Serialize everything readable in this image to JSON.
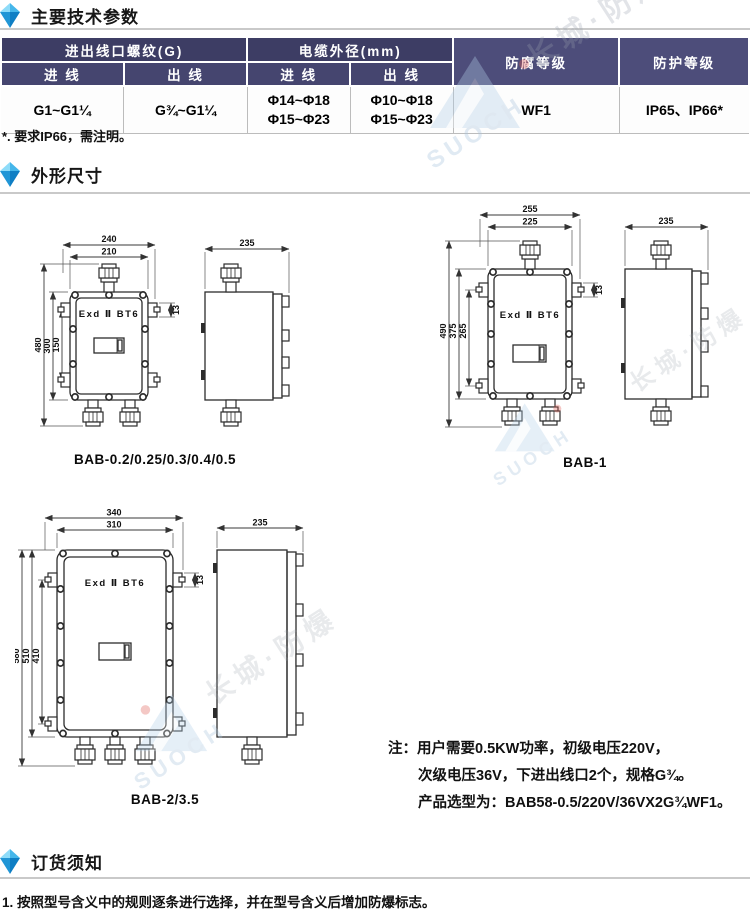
{
  "sections": {
    "main_params": "主要技术参数",
    "dimensions": "外形尺寸",
    "ordering": "订货须知"
  },
  "table": {
    "header": {
      "thread_group": "进出线口螺纹(G)",
      "cable_group": "电缆外径(mm)",
      "inlet": "进 线",
      "outlet": "出 线",
      "anticorrosion": "防腐等级",
      "protection": "防护等级"
    },
    "row": {
      "thread_in": "G1~G1¼",
      "thread_out": "G¾~G1¼",
      "cable_in_line1": "Φ14~Φ18",
      "cable_in_line2": "Φ15~Φ23",
      "cable_out_line1": "Φ10~Φ18",
      "cable_out_line2": "Φ15~Φ23",
      "anticorrosion": "WF1",
      "protection": "IP65、IP66*"
    },
    "footnote": "*. 要求IP66，需注明。"
  },
  "drawings": {
    "a": {
      "caption": "BAB-0.2/0.25/0.3/0.4/0.5",
      "marking": "Exd Ⅱ BT6",
      "dim_w1": "240",
      "dim_w2": "210",
      "dim_h1": "480",
      "dim_h2": "300",
      "dim_h3": "150",
      "dim_flange": "13",
      "dim_depth": "235"
    },
    "b": {
      "caption": "BAB-1",
      "marking": "Exd Ⅱ BT6",
      "dim_w1": "255",
      "dim_w2": "225",
      "dim_h1": "490",
      "dim_h2": "375",
      "dim_h3": "265",
      "dim_flange": "13",
      "dim_depth": "235"
    },
    "c": {
      "caption": "BAB-2/3.5",
      "marking": "Exd Ⅱ BT6",
      "dim_w1": "340",
      "dim_w2": "310",
      "dim_h1": "580",
      "dim_h2": "510",
      "dim_h3": "410",
      "dim_flange": "13",
      "dim_depth": "235"
    }
  },
  "note": {
    "line1": "注：用户需要0.5KW功率，初级电压220V，",
    "line2": "次级电压36V，下进出线口2个，规格G¾。",
    "line3": "产品选型为：BAB58-0.5/220V/36VX2G¾WF1。"
  },
  "ordering_item": "1. 按照型号含义中的规则逐条进行选择，并在型号含义后增加防爆标志。",
  "watermark": {
    "brand": "长城·防爆",
    "logo_text": "SUOCH"
  }
}
